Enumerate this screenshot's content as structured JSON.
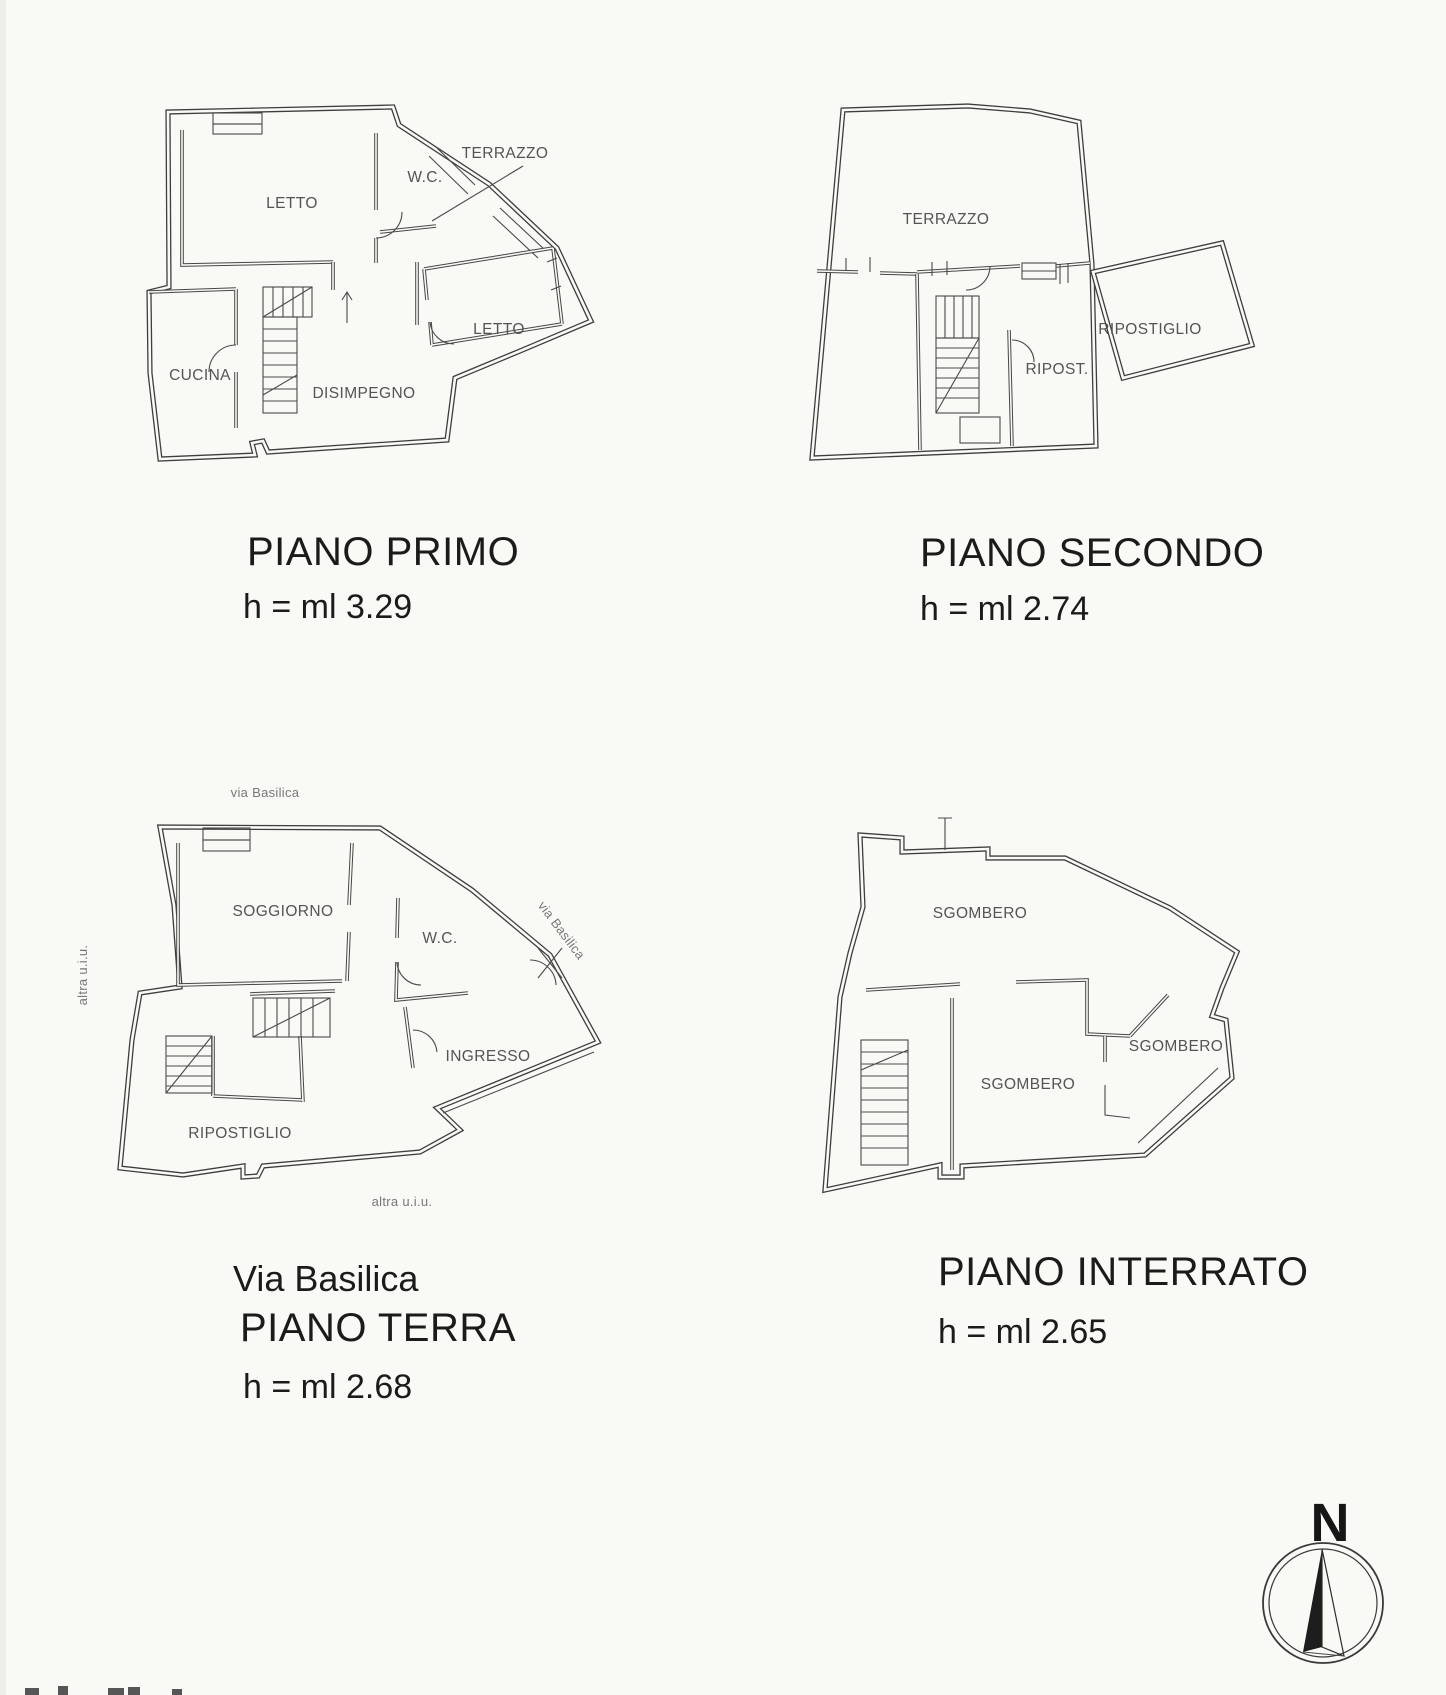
{
  "colors": {
    "paper": "#f9f9f6",
    "ink": "#3e3e3e",
    "room_label": "#545454",
    "faint_label": "#787878",
    "title": "#1b1b1b"
  },
  "plans": [
    {
      "id": "piano-primo",
      "title": "PIANO PRIMO",
      "height_label": "h = ml 3.29",
      "rooms": [
        {
          "label": "LETTO"
        },
        {
          "label": "W.C."
        },
        {
          "label": "TERRAZZO"
        },
        {
          "label": "LETTO"
        },
        {
          "label": "CUCINA"
        },
        {
          "label": "DISIMPEGNO"
        }
      ]
    },
    {
      "id": "piano-secondo",
      "title": "PIANO SECONDO",
      "height_label": "h = ml 2.74",
      "rooms": [
        {
          "label": "TERRAZZO"
        },
        {
          "label": "RIPOST."
        },
        {
          "label": "RIPOSTIGLIO"
        }
      ]
    },
    {
      "id": "piano-terra",
      "street_title": "Via Basilica",
      "title": "PIANO TERRA",
      "height_label": "h = ml 2.68",
      "rooms": [
        {
          "label": "SOGGIORNO"
        },
        {
          "label": "W.C."
        },
        {
          "label": "INGRESSO"
        },
        {
          "label": "RIPOSTIGLIO"
        }
      ],
      "annotations": [
        {
          "label": "via Basilica"
        },
        {
          "label": "via Basilica"
        },
        {
          "label": "altra u.i.u."
        },
        {
          "label": "altra u.i.u."
        }
      ]
    },
    {
      "id": "piano-interrato",
      "title": "PIANO INTERRATO",
      "height_label": "h = ml 2.65",
      "rooms": [
        {
          "label": "SGOMBERO"
        },
        {
          "label": "SGOMBERO"
        },
        {
          "label": "SGOMBERO"
        }
      ]
    }
  ],
  "compass": {
    "north_label": "N"
  }
}
